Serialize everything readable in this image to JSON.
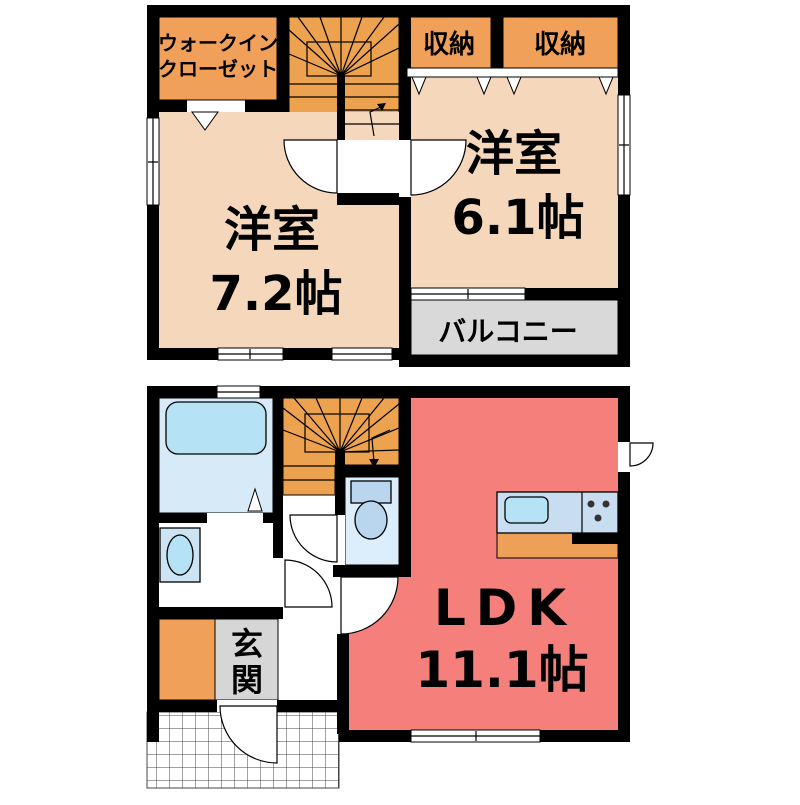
{
  "floor2": {
    "walk_in_closet": {
      "line1": "ウォークイン",
      "line2": "クローゼット"
    },
    "storage_left": {
      "label": "収納"
    },
    "storage_right": {
      "label": "収納"
    },
    "bedroom_left": {
      "name": "洋室",
      "size": "7.2帖"
    },
    "bedroom_right": {
      "name": "洋室",
      "size": "6.1帖"
    },
    "balcony": {
      "label": "バルコニー"
    }
  },
  "floor1": {
    "ldk": {
      "name": "LDK",
      "size": "11.1帖"
    },
    "entrance": {
      "line1": "玄",
      "line2": "関"
    }
  },
  "colors": {
    "wall": "#000000",
    "room_peach": "#F5D7BC",
    "closet_orange": "#F0A058",
    "stairs_orange": "#ECA24F",
    "balcony_gray": "#D9D9D9",
    "entrance_gray": "#D6D6D6",
    "ldk_red": "#F57F7B",
    "bath_blue": "#D6EBF7",
    "tub_blue": "#B5E3F5",
    "fixture_blue": "#BAD6EE",
    "toilet_room_blue": "#DCEEFB",
    "kitchen_blue": "#C8DEF0",
    "counter_orange": "#EFA058",
    "basin_blue": "#CCE4F4"
  }
}
